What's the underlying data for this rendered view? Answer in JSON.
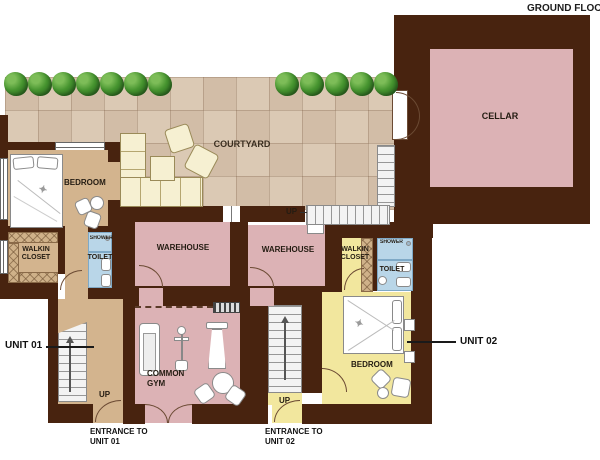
{
  "title": "GROUND FLOOR P",
  "rooms": {
    "courtyard": "COURTYARD",
    "cellar": "CELLAR",
    "bedroom1": "BEDROOM",
    "walkin1a": "WALKIN",
    "walkin1b": "CLOSET",
    "shower1": "SHOWER",
    "toilet1": "TOILET",
    "warehouse1": "WAREHOUSE",
    "warehouse2": "WAREHOUSE",
    "walkin2a": "WALKIN",
    "walkin2b": "CLOSET",
    "shower2": "SHOWER",
    "toilet2": "TOILET",
    "gym1": "COMMON",
    "gym2": "GYM",
    "bedroom2": "BEDROOM"
  },
  "labels": {
    "unit01": "UNIT 01",
    "unit02": "UNIT 02",
    "entrance1a": "ENTRANCE TO",
    "entrance1b": "UNIT 01",
    "entrance2a": "ENTRANCE TO",
    "entrance2b": "UNIT 02",
    "up_stairs1": "UP",
    "up_stairs2": "UP",
    "up_courtyard": "UP"
  },
  "icons": {
    "star": "✦"
  },
  "colors": {
    "wall": "#48230f",
    "room_pink": "#dcb2b5",
    "unit01_floor": "#d3b48e",
    "unit02_floor": "#f2e79e",
    "bathroom_blue": "#b9d6e8",
    "courtyard_tile": "#d8c5b0",
    "tree_green": "#46942f",
    "furniture_cream": "#f6f0d2"
  }
}
